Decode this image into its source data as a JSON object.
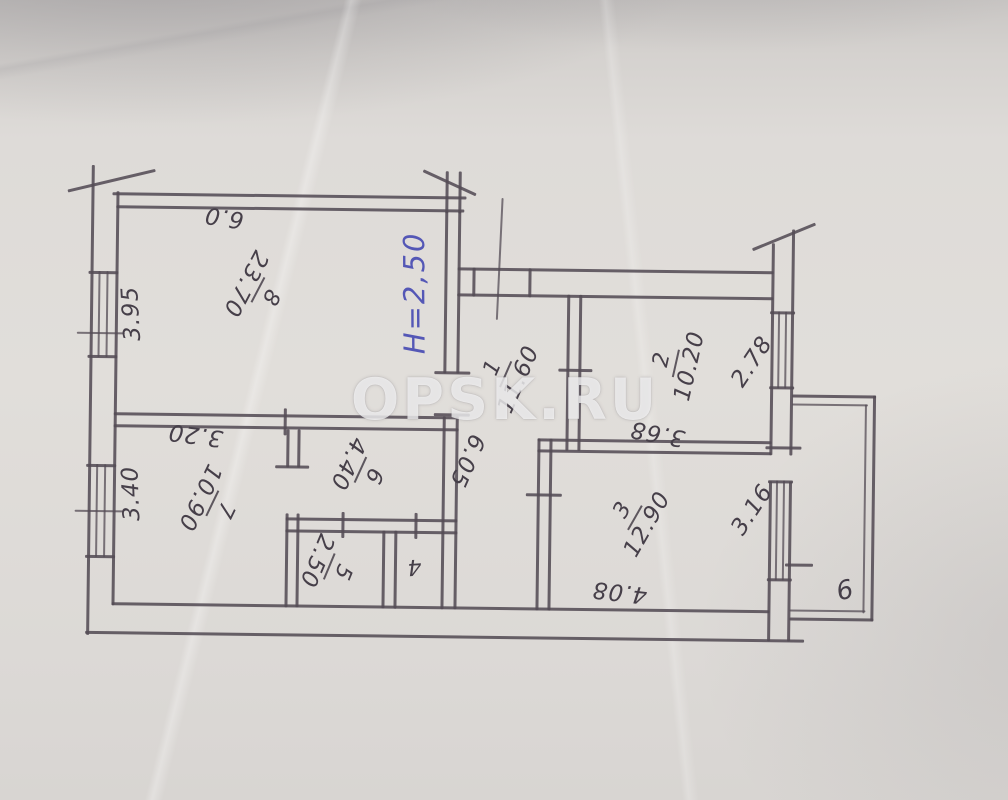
{
  "watermark": "OPSK.RU",
  "note_height": "H=2,50",
  "rooms": [
    {
      "id": "1",
      "area": "11.60"
    },
    {
      "id": "2",
      "area": "10.20"
    },
    {
      "id": "3",
      "area": "12.90"
    },
    {
      "id": "4",
      "area": ""
    },
    {
      "id": "5",
      "area": "2.50"
    },
    {
      "id": "6",
      "area": "4.40"
    },
    {
      "id": "7",
      "area": "10.90"
    },
    {
      "id": "8",
      "area": "23.70"
    },
    {
      "id": "9",
      "area": ""
    }
  ],
  "dimensions": {
    "room8_top_width": "6.0",
    "room8_left_depth": "3.95",
    "room7_top_width": "3.20",
    "room7_left_depth": "3.40",
    "corridor_length": "6.05",
    "room2_bottom_width": "3.68",
    "room2_right_depth": "2.78",
    "room3_right_depth": "3.16",
    "room3_bottom_width": "4.08"
  }
}
